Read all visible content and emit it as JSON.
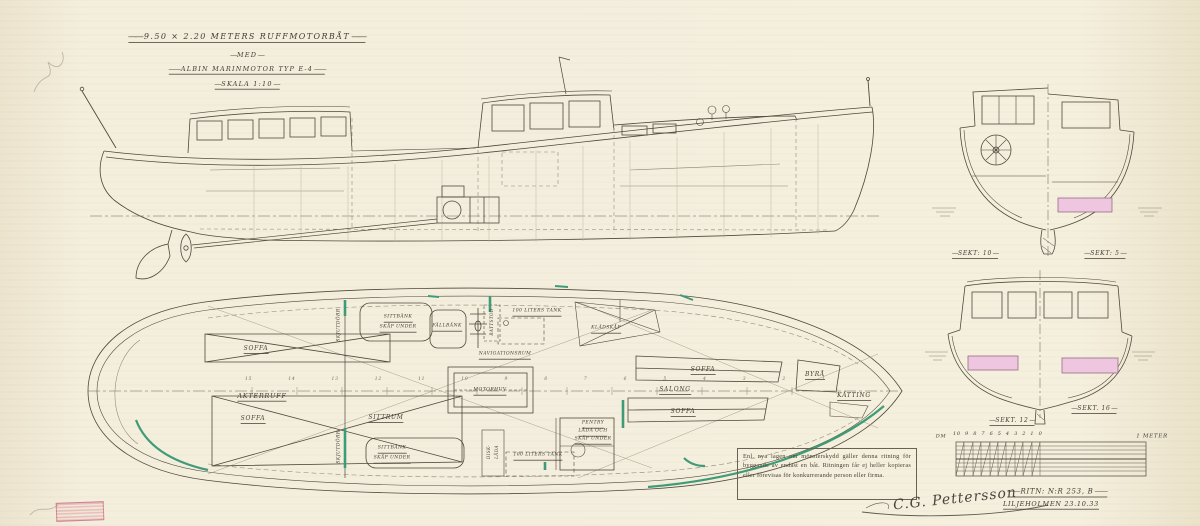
{
  "title_block": {
    "line1": "9.50 × 2.20 METERS RUFFMOTORBÅT",
    "line2": "MED",
    "line3": "ALBIN MARINMOTOR TYP E-4",
    "line4": "SKALA 1:10"
  },
  "plan": {
    "rooms": {
      "akterruff": "AKTERRUFF",
      "sittrum_aft": "SITTRUM",
      "navigationsrum": "NAVIGATIONSRUM",
      "salong": "SALONG"
    },
    "furniture": {
      "soffa_aft_top": "SOFFA",
      "soffa_aft_bottom": "SOFFA",
      "soffa_salong_top": "SOFFA",
      "soffa_salong_bottom": "SOFFA",
      "sittbank_top_1": "SITTBÄNK",
      "sittbank_top_2": "SKÅP UNDER",
      "sittbank_bottom_1": "SITTBÄNK",
      "sittbank_bottom_2": "SKÅP UNDER",
      "fallbank": "FÄLLBÄNK",
      "tank_top": "100 LITERS TANK",
      "tank_bottom": "100 LITERS TANK",
      "motorhuv": "MOTORHUV",
      "kladskap": "KLÄDSKÅP",
      "byra": "BYRÅ",
      "katting": "KÄTTING",
      "pentry_1": "PENTRY",
      "pentry_2": "LÅDA OCH",
      "pentry_3": "SKÅP UNDER",
      "skjutdorr_top": "SKJUTDÖRR",
      "skjutdorr_bottom": "SKJUTDÖRR",
      "rattstod": "RATTSTOD",
      "disklada_1": "DISK-",
      "disklada_2": "LÅDA"
    },
    "stations": "15 14 13 12 11 10 9 8 7 6 5 4 3 2 1"
  },
  "sections": {
    "sekt10": "SEKT: 10",
    "sekt5": "SEKT: 5",
    "sekt12": "SEKT. 12",
    "sekt16": "SEKT. 16"
  },
  "scale_bar": {
    "unit": "DM",
    "ticks": "10 9 8 7 6 5 4 3 2 1 0",
    "meter_label": "1 METER"
  },
  "legal_notice": "Enl. nya lagen om mönsterskydd gäller denna ritning för byggande av endast en båt. Ritningen får ej heller kopieras eller förevisas för konkurrerande person eller firma.",
  "footer": {
    "drawing_no": "RITN: N:r 253, B",
    "place_date": "LILJEHOLMEN 23.10.33",
    "signature": "C.G. Pettersson"
  },
  "colors": {
    "ink": "#50493c",
    "faint_ink": "#9a917d",
    "accent_green": "#3f9b77",
    "accent_pink": "#eec6e0",
    "paper": "#f3edda"
  }
}
